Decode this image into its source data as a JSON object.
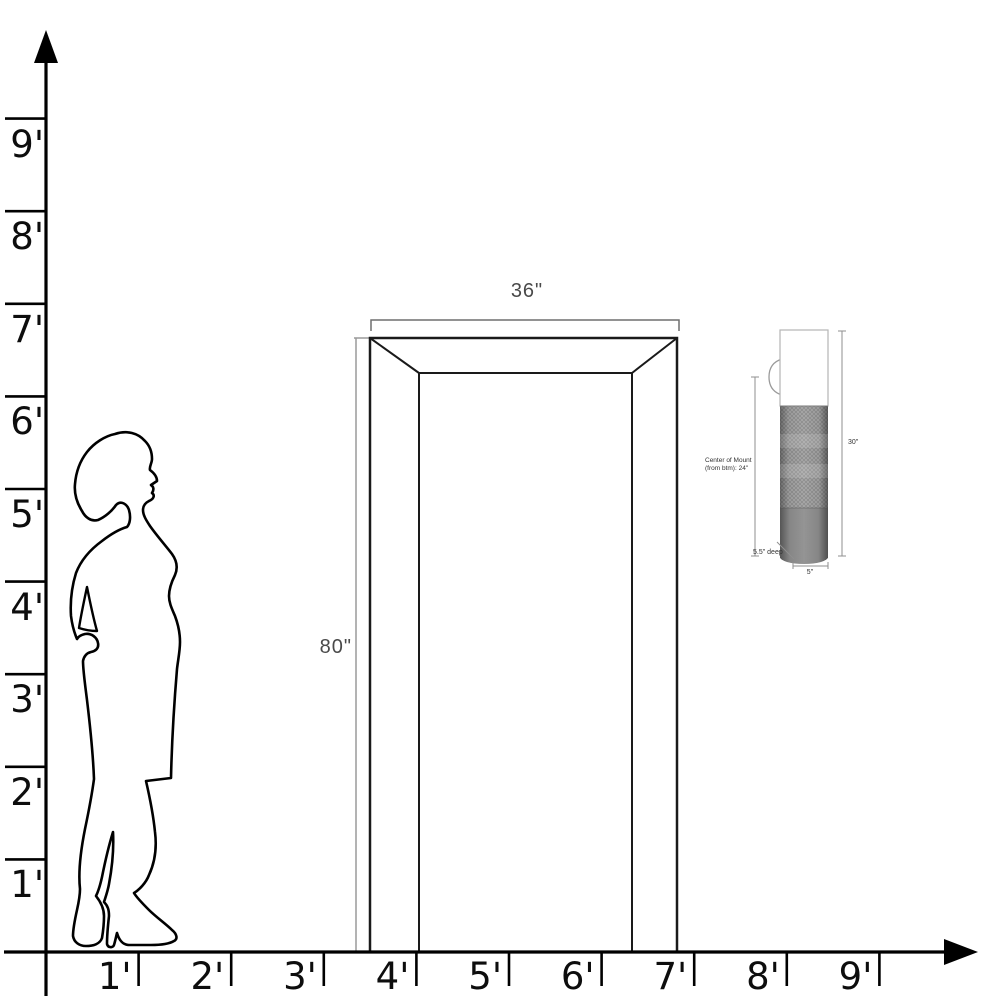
{
  "diagram": {
    "y_axis": {
      "ticks": [
        {
          "feet": 9,
          "label": "9'"
        },
        {
          "feet": 8,
          "label": "8'"
        },
        {
          "feet": 7,
          "label": "7'"
        },
        {
          "feet": 6,
          "label": "6'"
        },
        {
          "feet": 5,
          "label": "5'"
        },
        {
          "feet": 4,
          "label": "4'"
        },
        {
          "feet": 3,
          "label": "3'"
        },
        {
          "feet": 2,
          "label": "2'"
        },
        {
          "feet": 1,
          "label": "1'"
        }
      ]
    },
    "x_axis": {
      "ticks": [
        {
          "feet": 1,
          "label": "1'"
        },
        {
          "feet": 2,
          "label": "2'"
        },
        {
          "feet": 3,
          "label": "3'"
        },
        {
          "feet": 4,
          "label": "4'"
        },
        {
          "feet": 5,
          "label": "5'"
        },
        {
          "feet": 6,
          "label": "6'"
        },
        {
          "feet": 7,
          "label": "7'"
        },
        {
          "feet": 8,
          "label": "8'"
        },
        {
          "feet": 9,
          "label": "9'"
        }
      ]
    },
    "door": {
      "width_label": "36\"",
      "height_label": "80\""
    },
    "sconce": {
      "height_label": "30\"",
      "diameter_label": "5\"",
      "depth_label": "5.5\" deep",
      "mount_label_line1": "Center of Mount",
      "mount_label_line2": "(from btm): 24\""
    },
    "colors": {
      "axis_line": "#000000",
      "door_line": "#1a1a1a",
      "dimension_line": "#8f8f8f",
      "dimension_text": "#4a4a4a",
      "sconce_text": "#333333",
      "sconce_mesh": "#8f8f8f",
      "sconce_base": "#6e6e6e"
    }
  }
}
